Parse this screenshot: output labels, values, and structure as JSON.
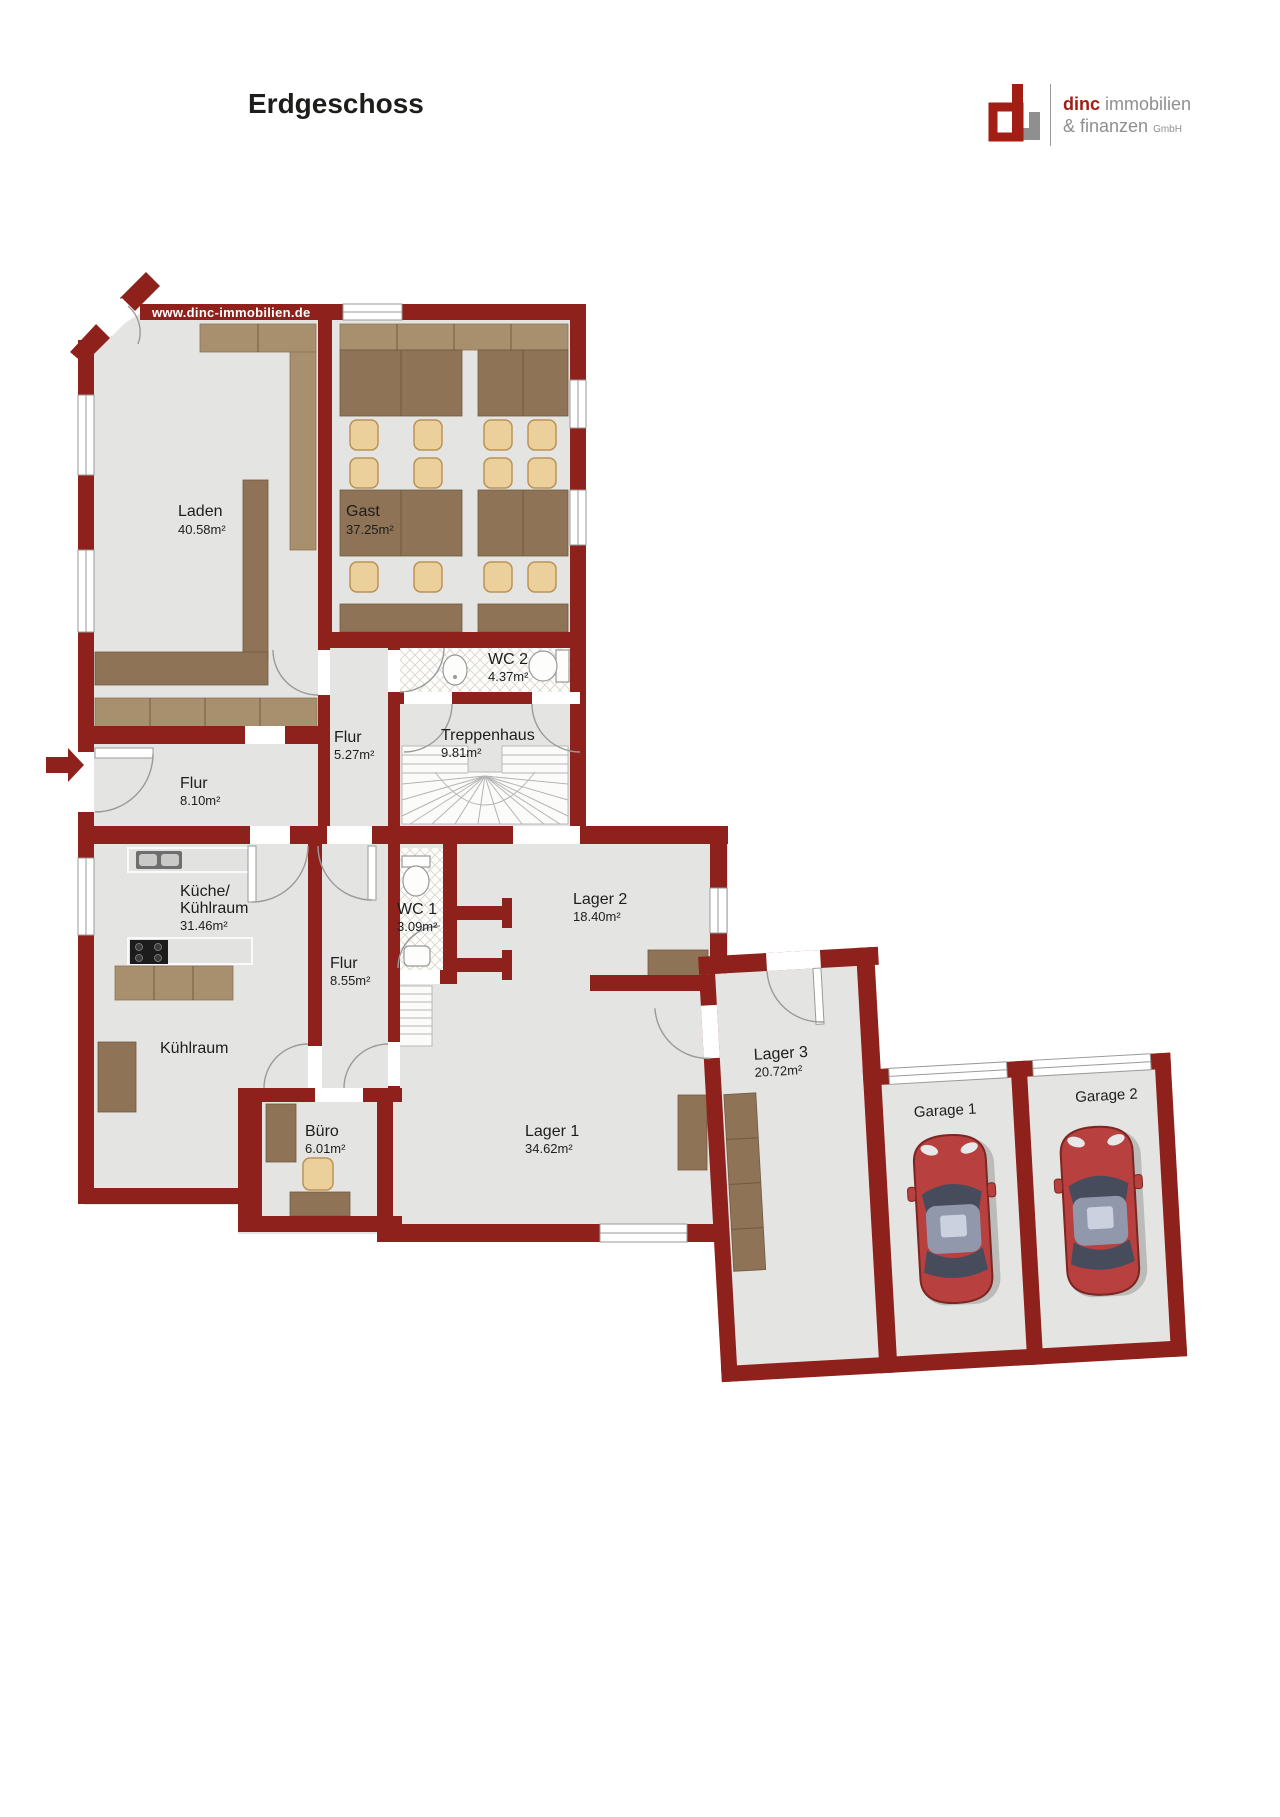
{
  "page": {
    "title": "Erdgeschoss",
    "watermark": "www.dinc-immobilien.de"
  },
  "logo": {
    "brand_bold": "dinc",
    "brand_rest": "immobilien",
    "line2": "& finanzen",
    "line2_small": "GmbH",
    "accent_color": "#a21e15",
    "gray_color": "#8f8f8f"
  },
  "colors": {
    "wall": "#8e211b",
    "floor": "#e4e4e2",
    "wood": "#8f7356",
    "wood_light": "#a8906f",
    "chair": "#ecd09b",
    "car": "#b8403f"
  },
  "rooms": [
    {
      "id": "laden",
      "name": "Laden",
      "area": "40.58m²"
    },
    {
      "id": "gast",
      "name": "Gast",
      "area": "37.25m²"
    },
    {
      "id": "wc2",
      "name": "WC 2",
      "area": "4.37m²"
    },
    {
      "id": "flur527",
      "name": "Flur",
      "area": "5.27m²"
    },
    {
      "id": "treppenhaus",
      "name": "Treppenhaus",
      "area": "9.81m²"
    },
    {
      "id": "flur810",
      "name": "Flur",
      "area": "8.10m²"
    },
    {
      "id": "kueche",
      "name_line1": "Küche/",
      "name_line2": "Kühlraum",
      "area": "31.46m²"
    },
    {
      "id": "wc1",
      "name": "WC 1",
      "area": "3.09m²"
    },
    {
      "id": "lager2",
      "name": "Lager 2",
      "area": "18.40m²"
    },
    {
      "id": "flur855",
      "name": "Flur",
      "area": "8.55m²"
    },
    {
      "id": "kuehlraum",
      "name": "Kühlraum",
      "area": ""
    },
    {
      "id": "buero",
      "name": "Büro",
      "area": "6.01m²"
    },
    {
      "id": "lager1",
      "name": "Lager 1",
      "area": "34.62m²"
    },
    {
      "id": "lager3",
      "name": "Lager 3",
      "area": "20.72m²"
    },
    {
      "id": "garage1",
      "name": "Garage 1",
      "area": ""
    },
    {
      "id": "garage2",
      "name": "Garage 2",
      "area": ""
    }
  ]
}
